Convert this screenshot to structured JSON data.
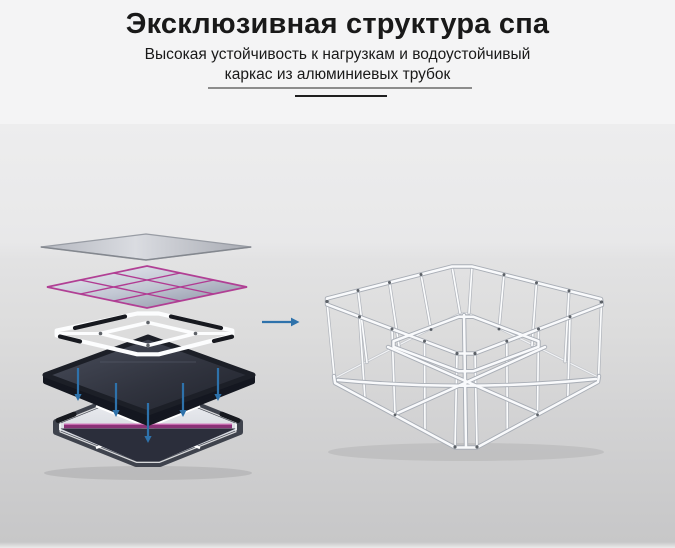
{
  "header": {
    "title": "Эксклюзивная структура спа",
    "subtitle_line1": "Высокая устойчивость к нагрузкам и водоустойчивый",
    "subtitle_line2": "каркас из алюминиевых трубок"
  },
  "illustration": {
    "down_arrow_count": 5,
    "right_arrow_count": 1,
    "layers": [
      "top-cover-sheet",
      "grid-cover-with-magenta-trim",
      "aluminium-tube-grid",
      "dark-liner",
      "base-panel"
    ],
    "result": "assembled-aluminium-tube-frame"
  },
  "colors": {
    "band_white": "#f4f4f5",
    "title_color": "#191919",
    "divider_gray": "#8c8c8c",
    "divider_black": "#1f1f1f",
    "accent_magenta": "#b13a92",
    "arrow_blue": "#2e72ab",
    "liner_dark": "#262a36",
    "frame_tube_white": "#f9fafc",
    "frame_tube_edge": "#a9aeb6"
  }
}
